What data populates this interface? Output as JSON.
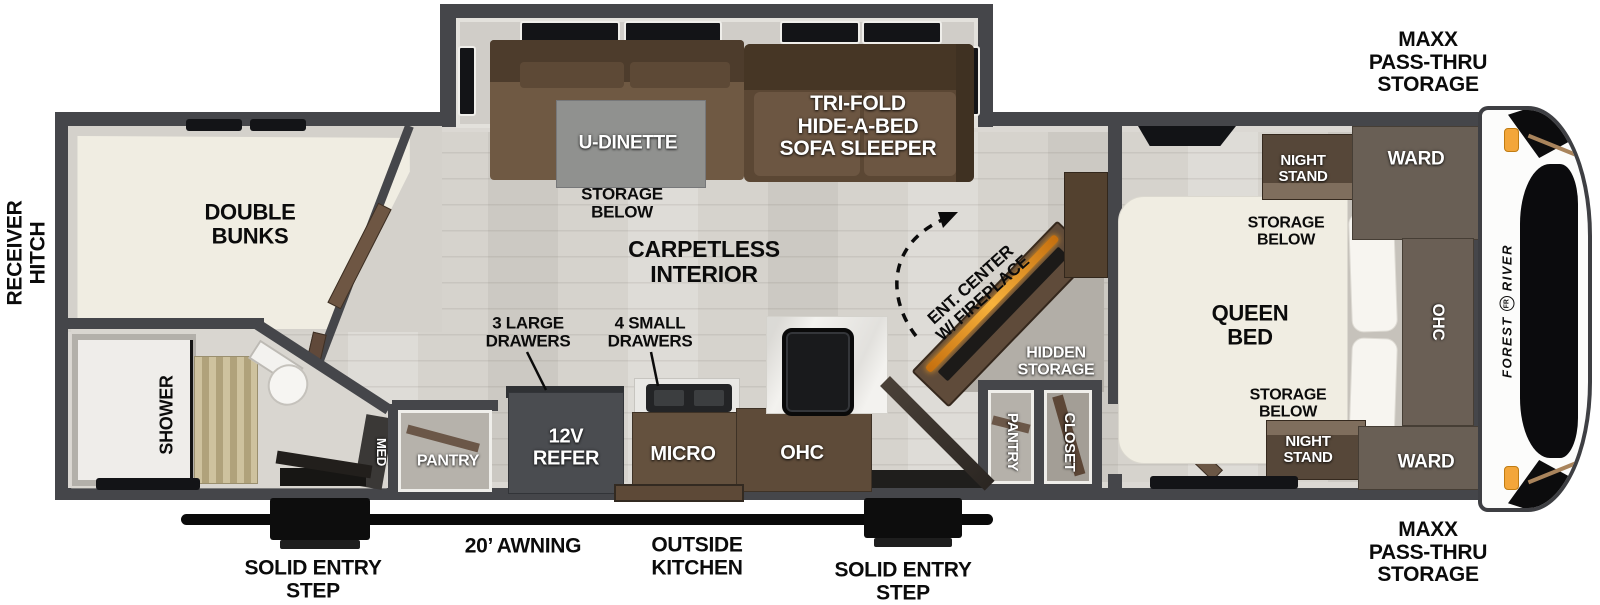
{
  "colors": {
    "wall": "#45464a",
    "floor": "#d6d3cd",
    "sofa_brown": "#5b4734",
    "cabinet_brown": "#63503d",
    "mattress_cream": "#f0ede2",
    "counter_white": "#f3f2ef",
    "fireplace_orange": "#f09b1f",
    "marker_light_orange": "#f3a63a"
  },
  "exterior": {
    "receiver_hitch": "RECEIVER\nHITCH",
    "maxx_pass_thru_top": "MAXX\nPASS-THRU\nSTORAGE",
    "maxx_pass_thru_bottom": "MAXX\nPASS-THRU\nSTORAGE",
    "solid_entry_step_left": "SOLID ENTRY\nSTEP",
    "awning": "20’ AWNING",
    "outside_kitchen": "OUTSIDE\nKITCHEN",
    "solid_entry_step_right": "SOLID ENTRY\nSTEP"
  },
  "bunk_room": {
    "double_bunks": "DOUBLE\nBUNKS"
  },
  "bathroom": {
    "shower": "SHOWER",
    "med": "MED",
    "pantry": "PANTRY"
  },
  "slideout": {
    "u_dinette": "U-DINETTE",
    "storage_below": "STORAGE\nBELOW",
    "sofa": "TRI-FOLD\nHIDE-A-BED\nSOFA SLEEPER"
  },
  "living": {
    "carpetless": "CARPETLESS\nINTERIOR",
    "large_drawers": "3 LARGE\nDRAWERS",
    "small_drawers": "4 SMALL\nDRAWERS",
    "ent_center": "ENT. CENTER\nW/ FIREPLACE",
    "hidden_storage": "HIDDEN\nSTORAGE",
    "pantry": "PANTRY",
    "closet": "CLOSET"
  },
  "kitchen": {
    "refer": "12V\nREFER",
    "micro": "MICRO",
    "ohc": "OHC"
  },
  "bedroom": {
    "night_stand_top": "NIGHT\nSTAND",
    "night_stand_bottom": "NIGHT\nSTAND",
    "ward_top": "WARD",
    "ward_bottom": "WARD",
    "storage_below_top": "STORAGE\nBELOW",
    "storage_below_bottom": "STORAGE\nBELOW",
    "queen_bed": "QUEEN\nBED",
    "ohc": "OHC"
  },
  "front_cap": {
    "brand_first": "FOREST",
    "brand_logo": "FR",
    "brand_last": "RIVER"
  }
}
